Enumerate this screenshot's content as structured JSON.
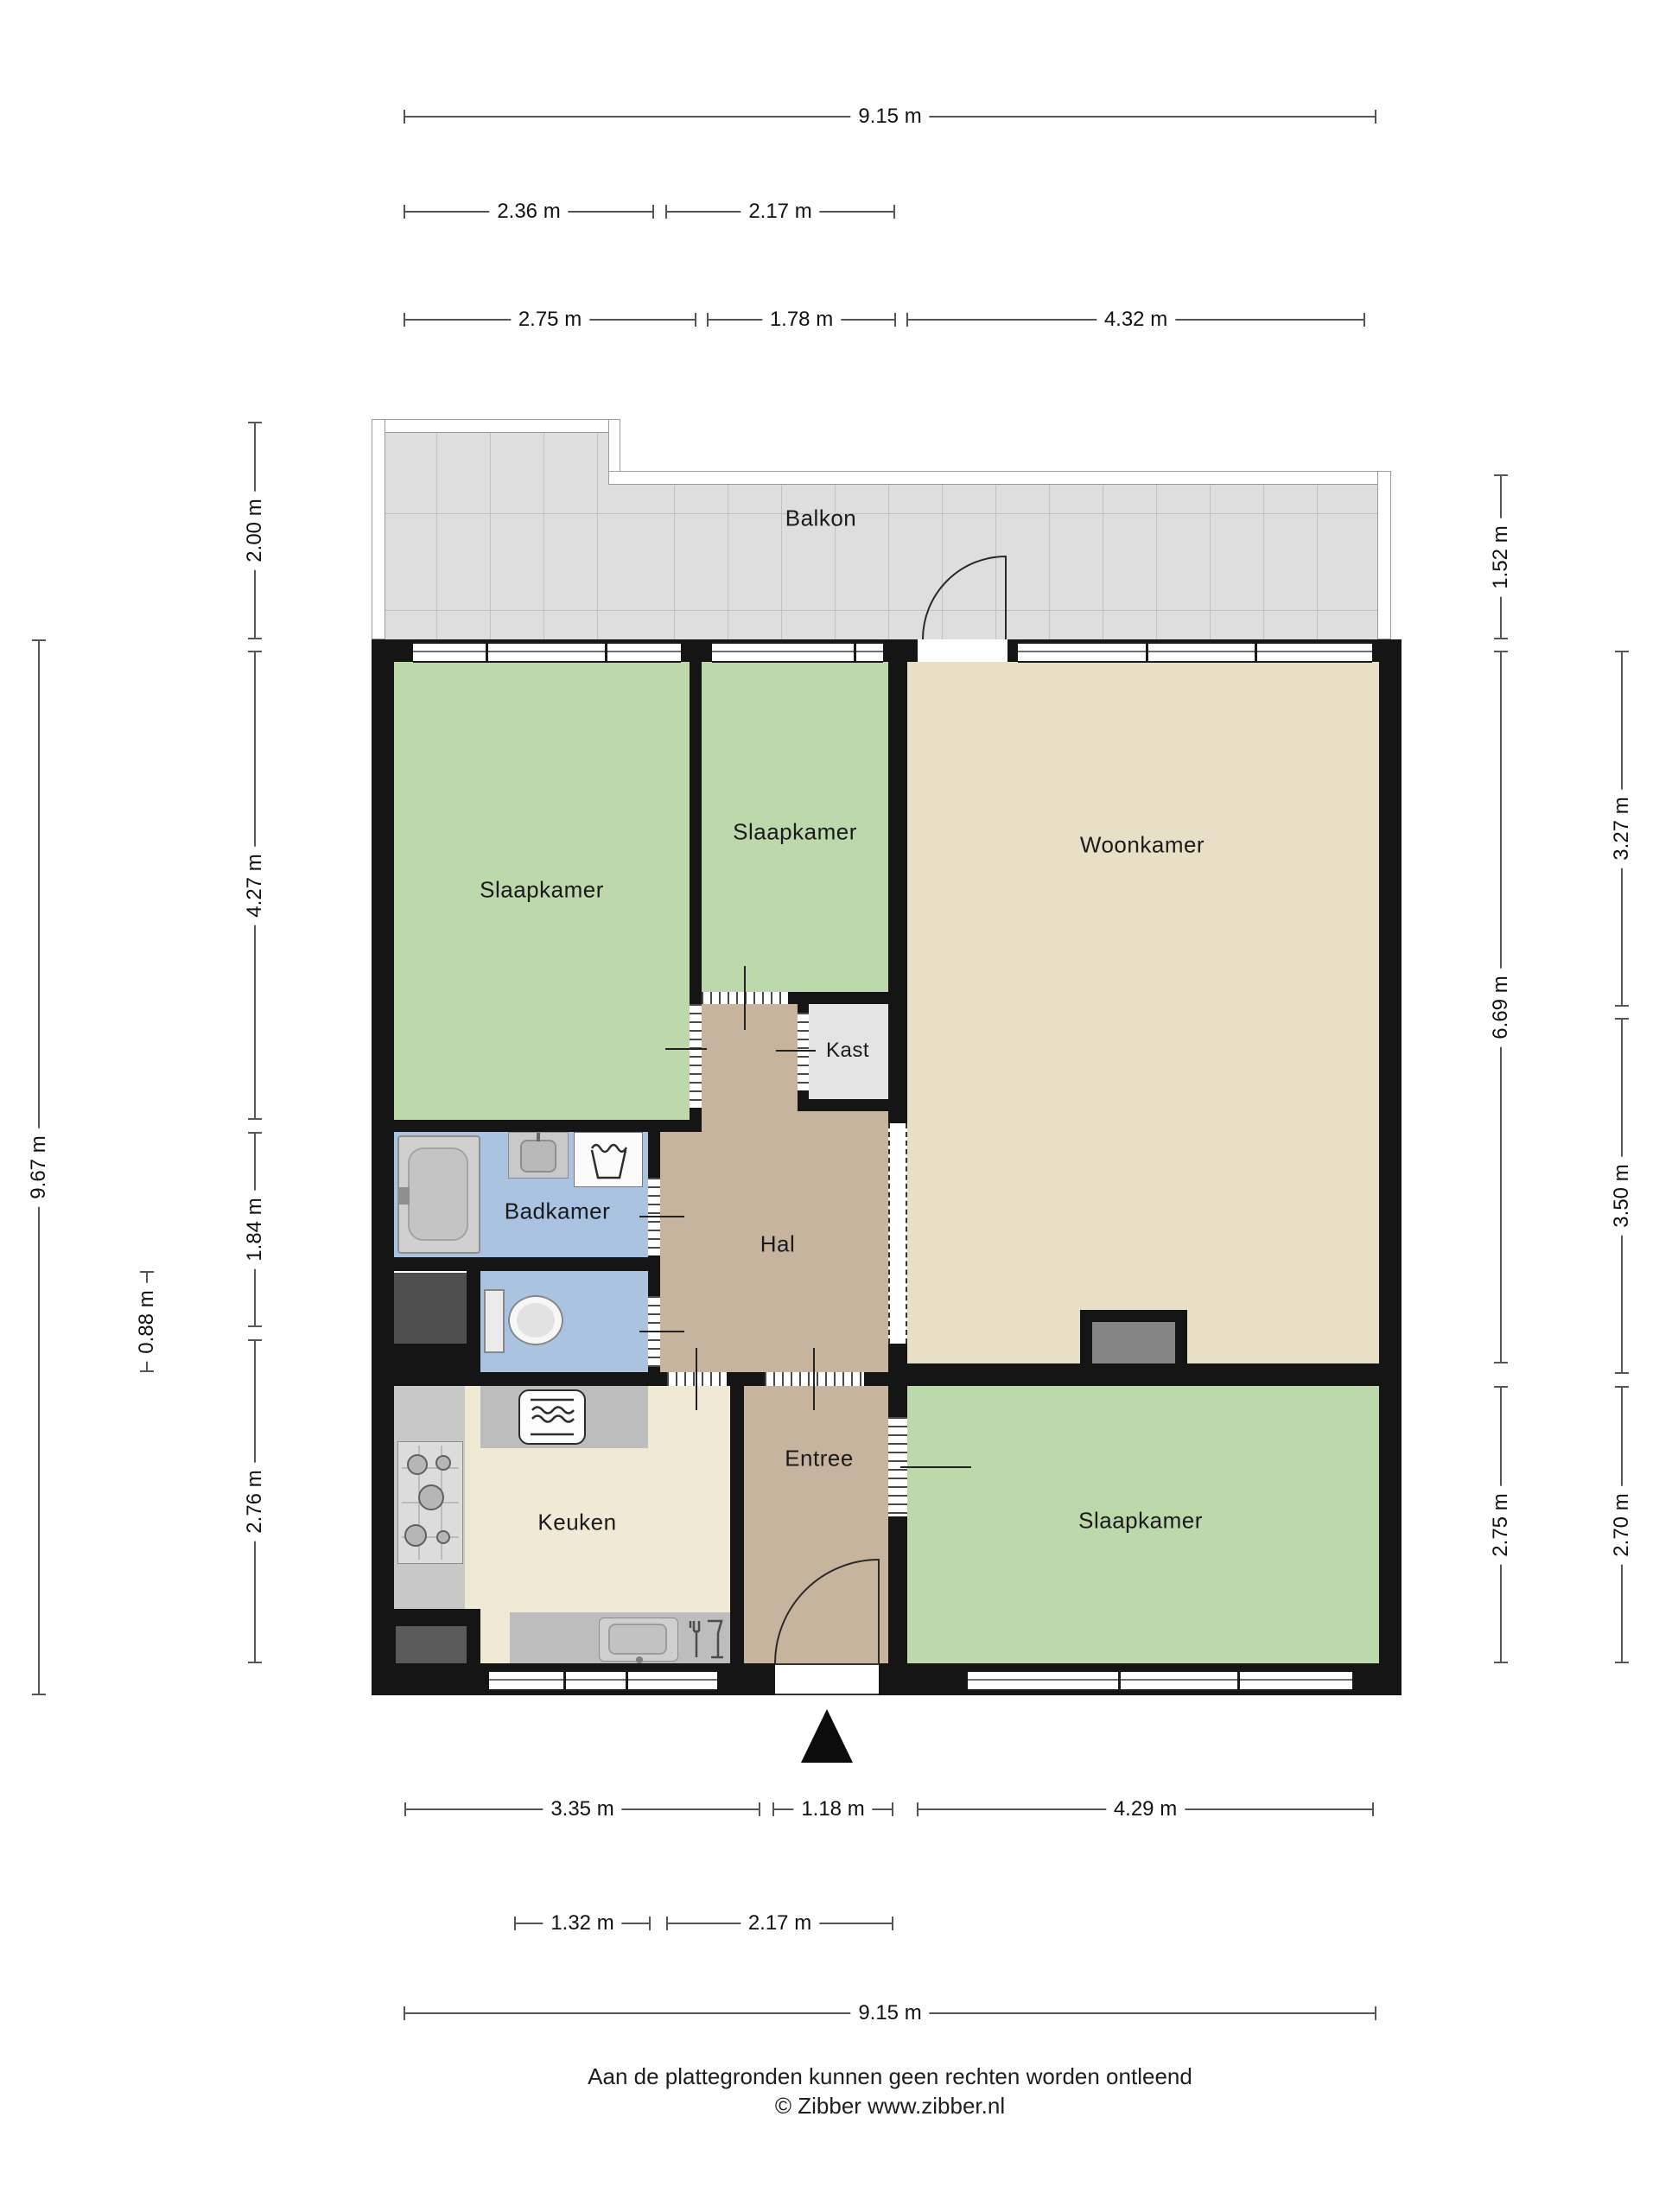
{
  "rooms": {
    "balkon": "Balkon",
    "slaapkamer_left": "Slaapkamer",
    "slaapkamer_middle": "Slaapkamer",
    "slaapkamer_bottom": "Slaapkamer",
    "woonkamer": "Woonkamer",
    "kast": "Kast",
    "hal": "Hal",
    "badkamer": "Badkamer",
    "keuken": "Keuken",
    "entree": "Entree"
  },
  "dimensions": {
    "top_total": "9.15 m",
    "top_row2": [
      "2.36 m",
      "2.17 m"
    ],
    "top_row3": [
      "2.75 m",
      "1.78 m",
      "4.32 m"
    ],
    "bottom_row1": [
      "3.35 m",
      "1.18 m",
      "4.29 m"
    ],
    "bottom_row2": [
      "1.32 m",
      "2.17 m"
    ],
    "bottom_total": "9.15 m",
    "left_outer": "9.67 m",
    "left_inner": [
      "2.00 m",
      "4.27 m",
      "1.84 m",
      "2.76 m"
    ],
    "left_small": "0.88 m",
    "right_inner": [
      "1.52 m",
      "6.69 m",
      "2.75 m"
    ],
    "right_outer": [
      "3.27 m",
      "3.50 m",
      "2.70 m"
    ]
  },
  "footer": {
    "disclaimer": "Aan de plattegronden kunnen geen rechten worden ontleend",
    "copyright": "© Zibber www.zibber.nl"
  },
  "colors": {
    "bedroom_green": "#bdd8ab",
    "livingroom_beige": "#e7dfc6",
    "kitchen_cream": "#f0e9d5",
    "hall_tan": "#c7b49f",
    "bathroom_blue": "#a9c3e1",
    "closet_gray": "#e4e4e4",
    "balcony_gray": "#dedede",
    "wall_black": "#151515"
  }
}
